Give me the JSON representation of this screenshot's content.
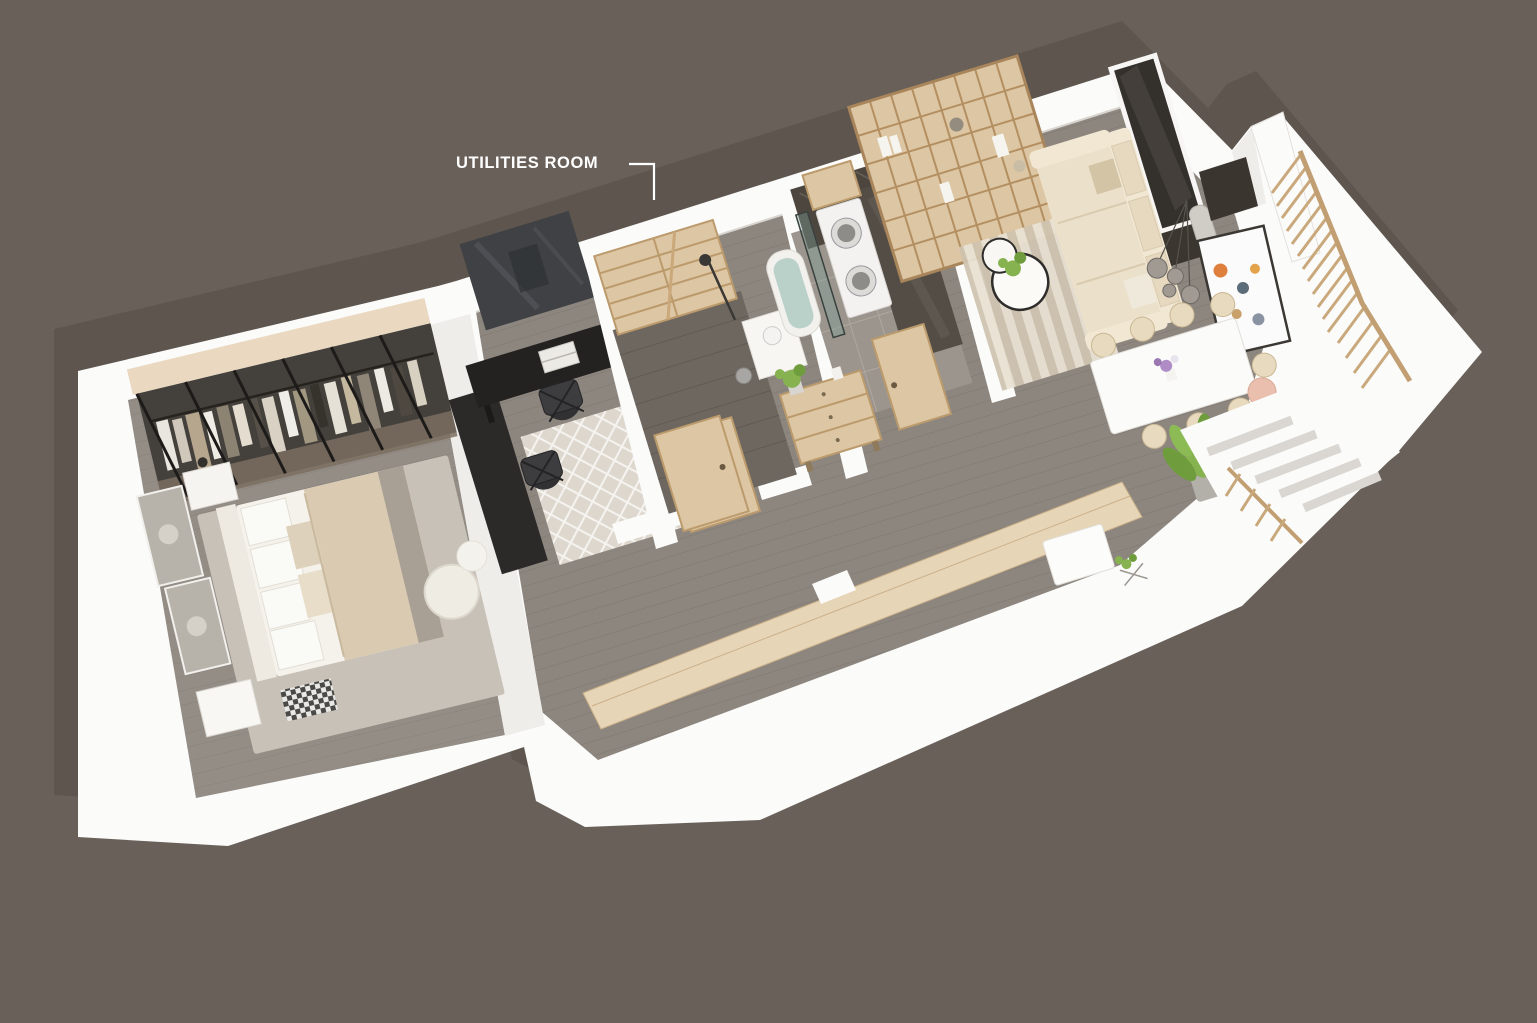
{
  "annotation": {
    "label": "UTILITIES ROOM"
  },
  "colors": {
    "background": "#696059",
    "shadow": "#5d554e",
    "wall": "#fbfbfa",
    "wall_shade": "#efedea",
    "floor_main": "#8d867f",
    "floor_bedroom": "#948d86",
    "floor_utilities": "#6e6760",
    "wood": "#ddc6a3",
    "wood_dark": "#bb9a6c",
    "wood_light": "#ead9c0",
    "sideboard": "#e7d5b7",
    "glass_dark": "#3f4145",
    "marble": "#4c463f",
    "tub": "#bad1ca",
    "sofa": "#ebe0ca",
    "plant": "#86b34f",
    "railing": "#c9a87b",
    "desk": "#232221",
    "label_text": "#ffffff"
  }
}
